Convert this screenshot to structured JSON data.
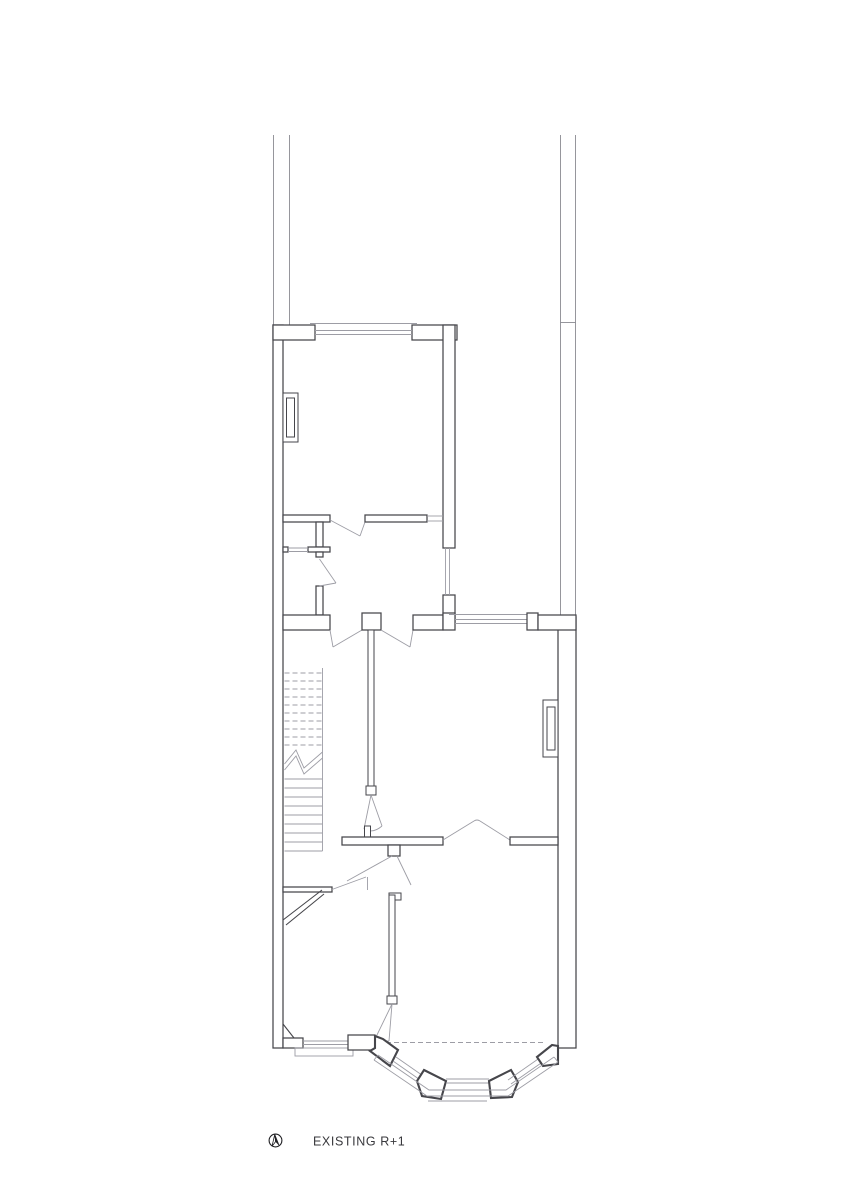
{
  "drawing": {
    "label": "EXISTING R+1",
    "type": "architectural floor plan",
    "north_arrow_icon": "north-arrow"
  },
  "colors": {
    "background": "#ffffff",
    "wall_line": "#46464b",
    "thin_line": "#9d9da5",
    "party_wall_line": "#8b8b92",
    "text_color": "#39393d",
    "north_fill": "#1f1f23"
  }
}
